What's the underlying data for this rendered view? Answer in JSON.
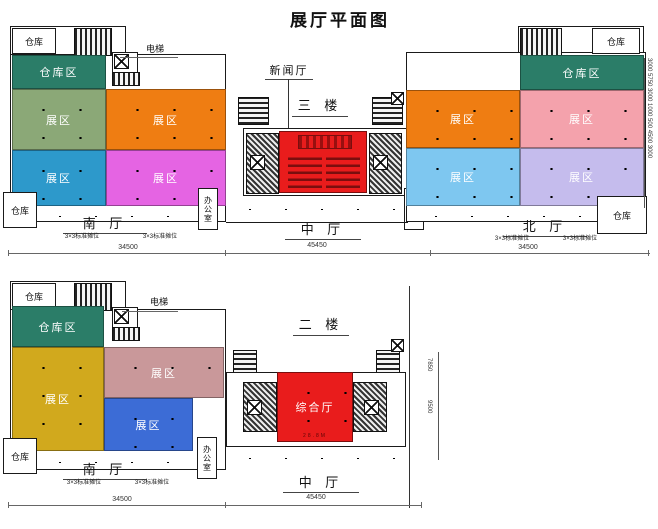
{
  "title": "展厅平面图",
  "colors": {
    "storage_teal": "#2B7D68",
    "zone_sage_green": "#8BA877",
    "zone_orange": "#EF7D12",
    "zone_cyan_blue": "#2D99CB",
    "zone_magenta": "#E564E3",
    "zone_salmon_pink": "#F4A2AC",
    "zone_light_blue": "#7EC7F0",
    "zone_lavender": "#C5BCED",
    "hall_red": "#E91C1C",
    "zone_gold": "#D1A91D",
    "zone_dusty_pink": "#C9989A",
    "zone_royal_blue": "#3C6CD6"
  },
  "floor3": {
    "floor_label": "三 楼",
    "news_hall_label": "新闻厅",
    "elevator_label": "电梯",
    "warehouse_top_left": "仓库",
    "warehouse_bottom_left": "仓库",
    "warehouse_top_right": "仓库",
    "warehouse_bottom_right": "仓库",
    "zones": {
      "storage_left": "仓库区",
      "sage_green": "展区",
      "orange_left": "展区",
      "cyan_blue": "展区",
      "magenta": "展区",
      "storage_right": "仓库区",
      "orange_right": "展区",
      "salmon_pink": "展区",
      "light_blue": "展区",
      "lavender": "展区"
    },
    "south_hall": "南 厅",
    "central_hall": "中 厅",
    "north_hall": "北 厅",
    "office": "办公室",
    "booth_note": "3×3标准摊位",
    "dim_south": "34500",
    "dim_central": "45450",
    "dim_north": "34500",
    "dim_right_chain": "3000 5750 3000 1000 500 4500 3000"
  },
  "floor2": {
    "floor_label": "二 楼",
    "elevator_label": "电梯",
    "warehouse_top_left": "仓库",
    "warehouse_bottom_left": "仓库",
    "zones": {
      "storage": "仓库区",
      "gold": "展区",
      "dusty_pink": "展区",
      "royal_blue": "展区",
      "multi_hall": "综合厅"
    },
    "multi_hall_dim": "28.8M",
    "south_hall": "南 厅",
    "central_hall": "中 厅",
    "office": "办公室",
    "booth_note": "3×3标准摊位",
    "dim_south": "34500",
    "dim_central": "45450",
    "dim_right_upper": "7850",
    "dim_right_lower": "9500"
  }
}
